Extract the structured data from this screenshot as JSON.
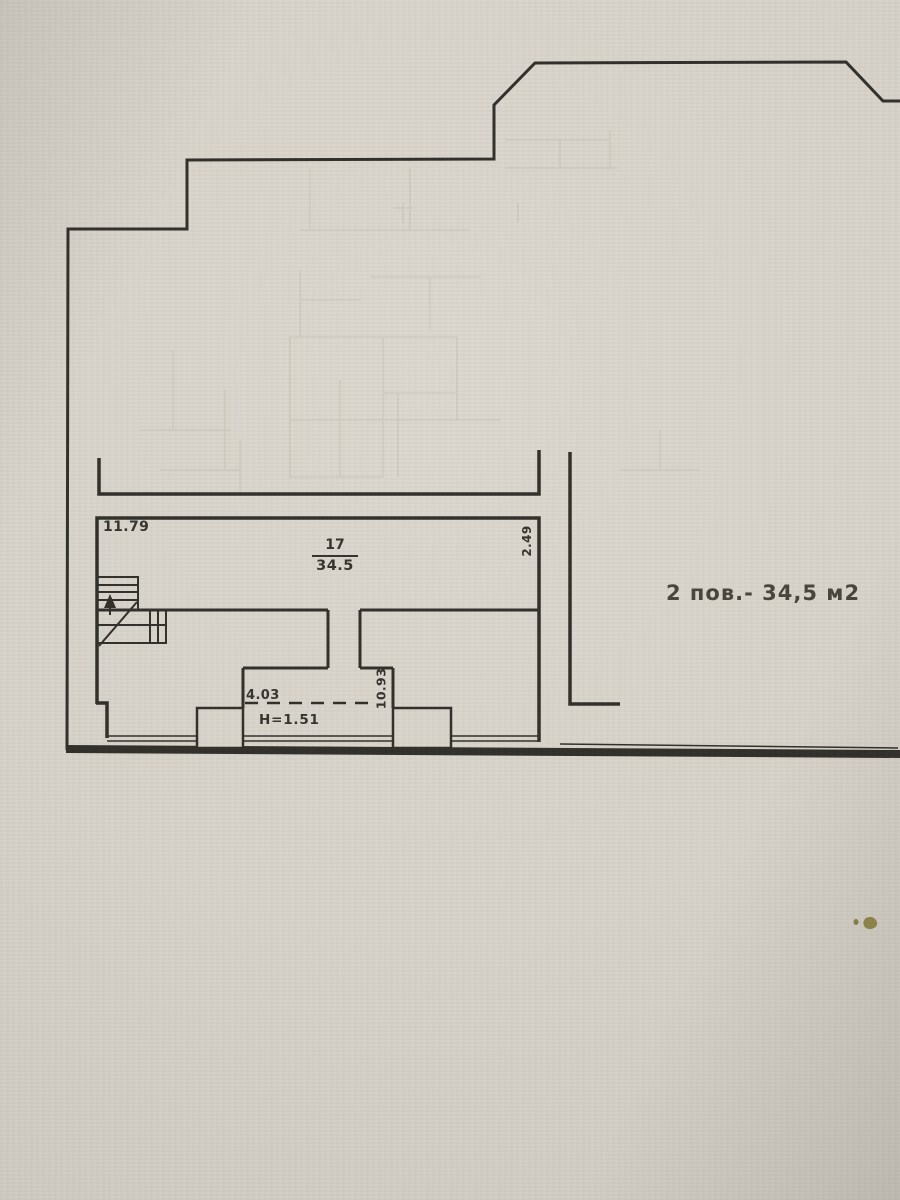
{
  "labels": {
    "dim_top_width": "11.79",
    "room_number": "17",
    "room_area": "34.5",
    "dim_right_height": "2.49",
    "dim_opening_width": "4.03",
    "dim_opening_depth": "10.93",
    "dim_opening_height": "H=1.51",
    "floor_area_note": "2 пов.- 34,5 м2"
  },
  "colors": {
    "ink": "#2f2d28",
    "paper_center": "#dcd8cf",
    "paper_edge": "#b2aea5",
    "ghost_ink": "#c6c1b3",
    "stain": "#847838"
  }
}
